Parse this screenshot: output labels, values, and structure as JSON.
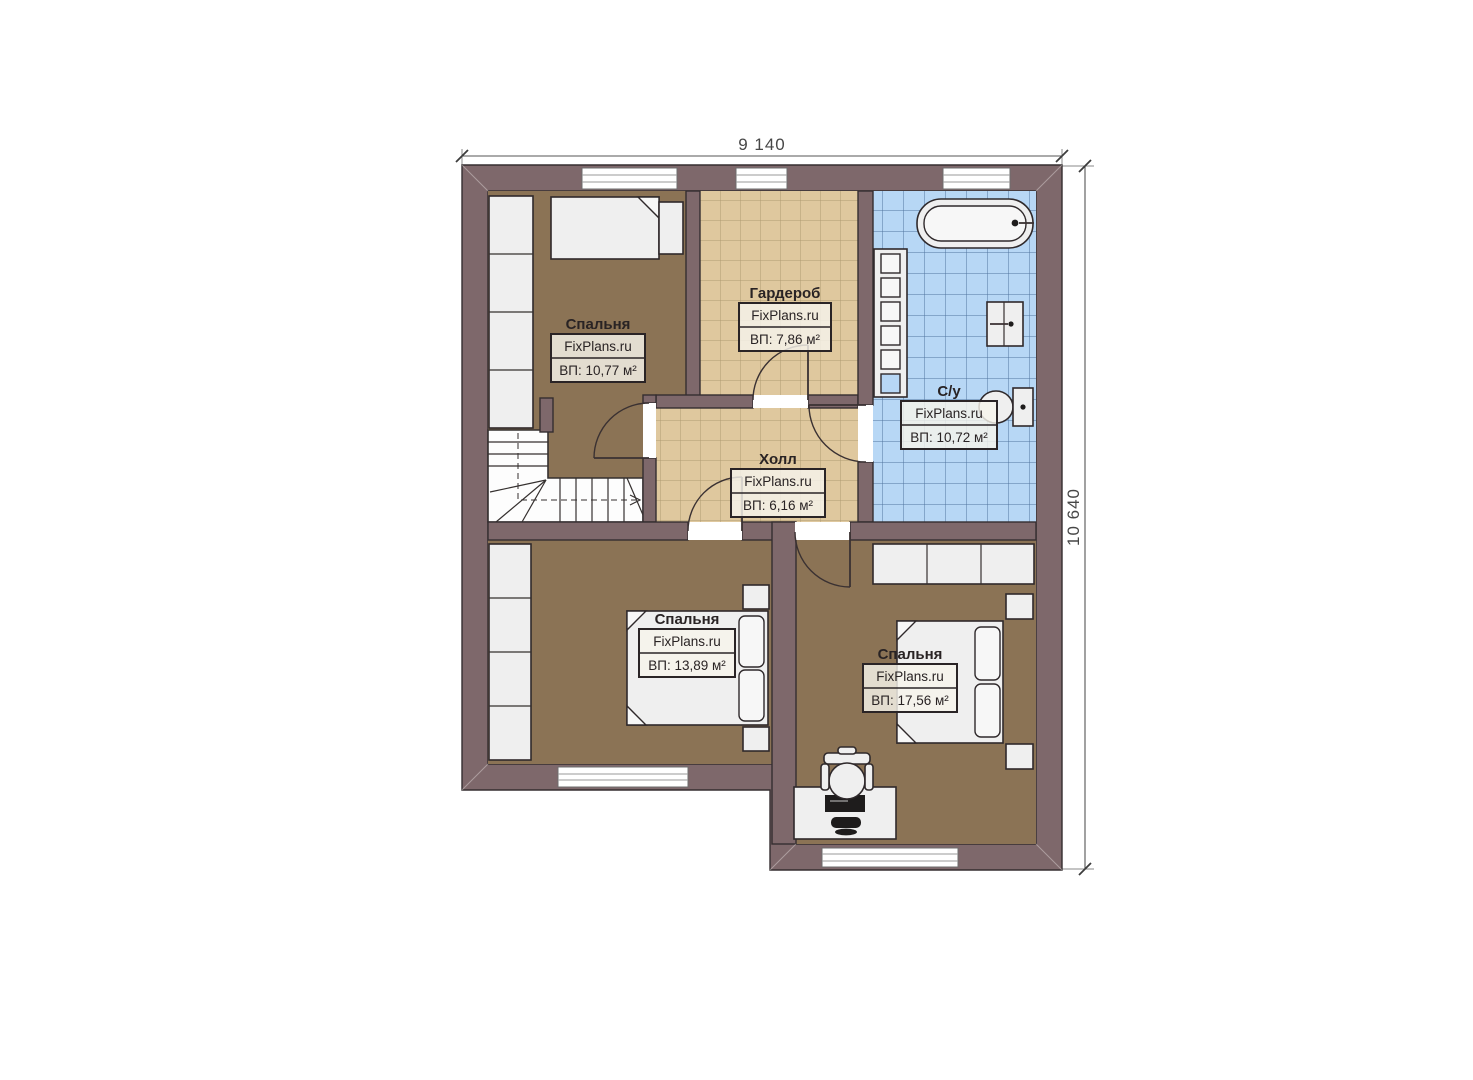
{
  "plan": {
    "dimensions": {
      "top": "9 140",
      "right": "10 640"
    },
    "watermark": "FixPlans.ru",
    "rooms": [
      {
        "id": "bedroom-top-left",
        "name": "Спальня",
        "area": "ВП: 10,77 м²"
      },
      {
        "id": "wardrobe-room",
        "name": "Гардероб",
        "area": "ВП: 7,86 м²"
      },
      {
        "id": "bathroom",
        "name": "С/у",
        "area": "ВП: 10,72 м²"
      },
      {
        "id": "hall",
        "name": "Холл",
        "area": "ВП: 6,16 м²"
      },
      {
        "id": "bedroom-bottom-middle",
        "name": "Спальня",
        "area": "ВП: 13,89 м²"
      },
      {
        "id": "bedroom-bottom-right",
        "name": "Спальня",
        "area": "ВП: 17,56 м²"
      }
    ],
    "colors": {
      "wall": "#7e686b",
      "outline": "#352e30",
      "floor_wood": "#8b7355",
      "tile_tan": "#dfc89e",
      "tile_tan_grid": "#9c8860",
      "tile_blue": "#b7d7f5",
      "tile_blue_grid": "#456a95",
      "furniture": "#efefef"
    }
  }
}
